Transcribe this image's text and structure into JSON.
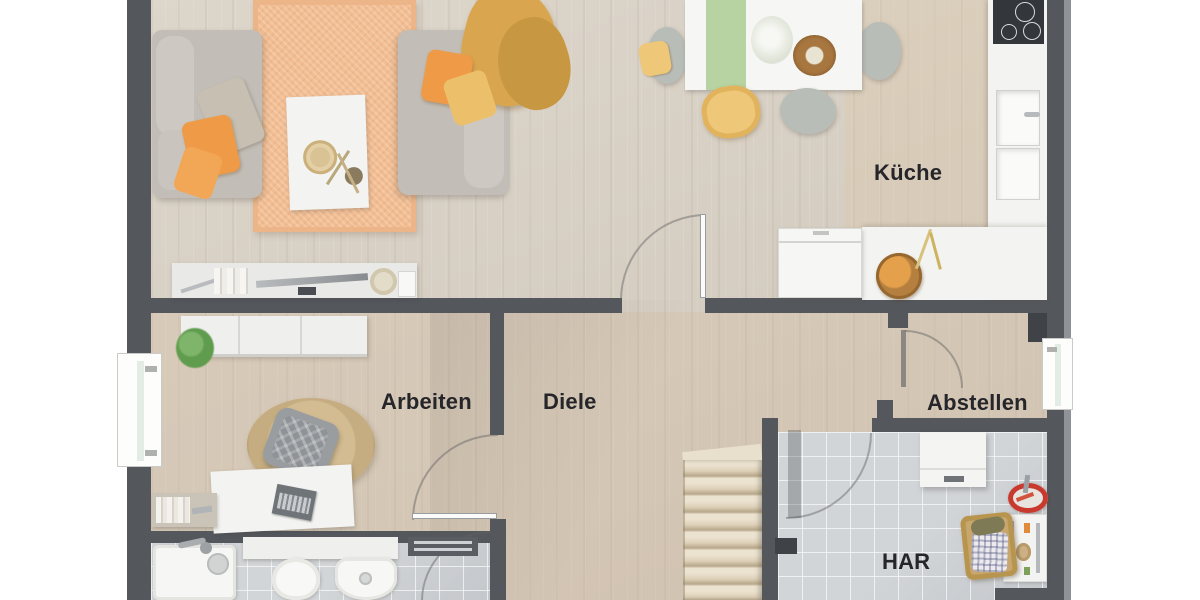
{
  "rooms": {
    "kueche": {
      "label": "Küche"
    },
    "arbeiten": {
      "label": "Arbeiten"
    },
    "diele": {
      "label": "Diele"
    },
    "abstellen": {
      "label": "Abstellen"
    },
    "har": {
      "label": "HAR"
    }
  },
  "palette": {
    "wall_gray": "#54585d",
    "floor_wood": "#d9d1c5",
    "floor_tile": "#d2d5d8",
    "rug_peach": "#f2bd92",
    "rug_jute": "#d3bc92",
    "sofa_gray": "#c2beb7",
    "pillow_orange": "#ef9a47",
    "pillow_yellow": "#ecc06a",
    "throw_mustard": "#d9a54f",
    "runner_green": "#b7d3a2",
    "chair_yellow": "#eec878",
    "counter_white": "#f3f3f1",
    "cooktop_black": "#33373b",
    "toolbox_red": "#c93a2e",
    "stairs_beige": "#ddd0b8"
  }
}
